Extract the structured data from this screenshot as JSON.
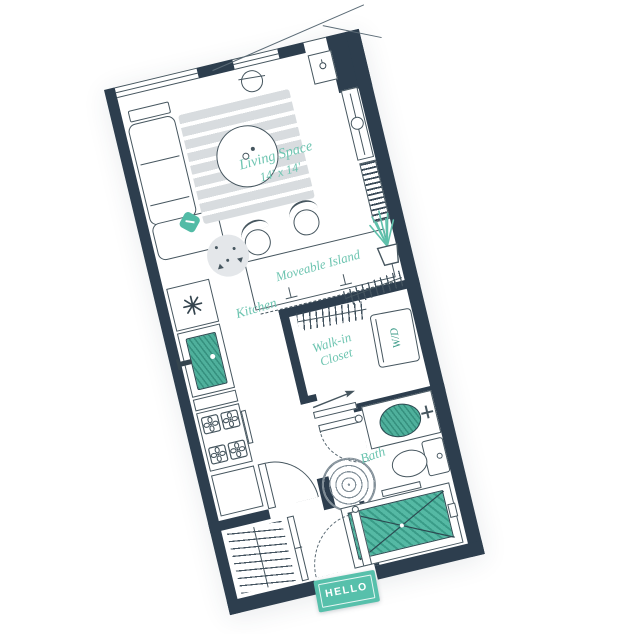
{
  "plan": {
    "title_note": "studio apartment floor plan",
    "rotation_deg": -13.5,
    "labels": {
      "living_space": "Living Space",
      "living_dims": "14' x 14'",
      "island": "Moveable Island",
      "kitchen": "Kitchen",
      "closet_line1": "Walk-in",
      "closet_line2": "Closet",
      "bath": "Bath",
      "washer_dryer": "W/D",
      "doormat": "HELLO"
    },
    "colors": {
      "wall": "#2d3e4e",
      "outline": "#46565f",
      "teal_accent": "#52bba6",
      "teal_dark": "#3a9c88",
      "teal_text": "#6ec5b1",
      "rug_gray": "#d8dcdf",
      "ring_gray": "#828f98",
      "mat_teal": "#57c0ab"
    }
  }
}
